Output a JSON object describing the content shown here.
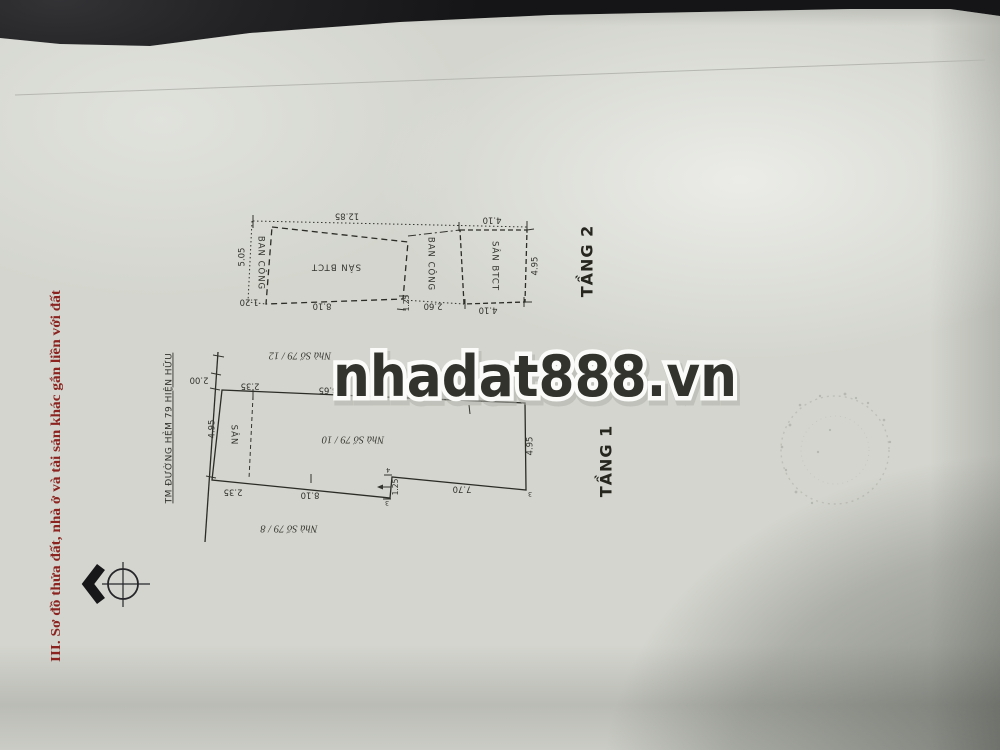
{
  "document": {
    "section_heading": "III. Sơ đồ thửa đất, nhà ở và tài sản khác gắn liền với đất",
    "watermark": "nhadat888.vn",
    "heading_color": "#8b2420",
    "watermark_color": "#7d80d8",
    "paper_color": "#d3d5ce"
  },
  "floor2": {
    "label": "TẦNG 2",
    "room_labels": {
      "balcony_left": "BAN CÔNG",
      "main": "SÂN BTCT",
      "balcony_mid": "BAN CÔNG",
      "terrace_right": "SÂN BTCT"
    },
    "dimensions": {
      "top": "12.85",
      "top_right": "4.10",
      "left": "5.05",
      "bottom_left": "1.20",
      "bottom": "8.10",
      "notch": "1.25",
      "balcony_bottom": "2.60",
      "bottom_right": "4.10",
      "right": "4.95"
    }
  },
  "floor1": {
    "label": "TẦNG 1",
    "alley_label": "TM ĐƯỜNG HẺM 79 HIỆN HỮU",
    "yard_label": "SÂN",
    "house_label": "Nhà Số 79 / 10",
    "neighbor_top_label": "Nhà Số 79 / 12",
    "neighbor_bottom_label": "Nhà Số 79 / 8",
    "dimensions": {
      "alley_frontage": "2.00",
      "yard_top": "2.35",
      "yard_left": "4.95",
      "yard_bottom": "2.35",
      "top": "8.65",
      "top_right": "7.70",
      "bottom": "8.10",
      "notch": "1.25",
      "bottom_right": "7.70",
      "right": "4.95"
    },
    "point_markers": [
      "5",
      "4",
      "3",
      "3"
    ]
  }
}
